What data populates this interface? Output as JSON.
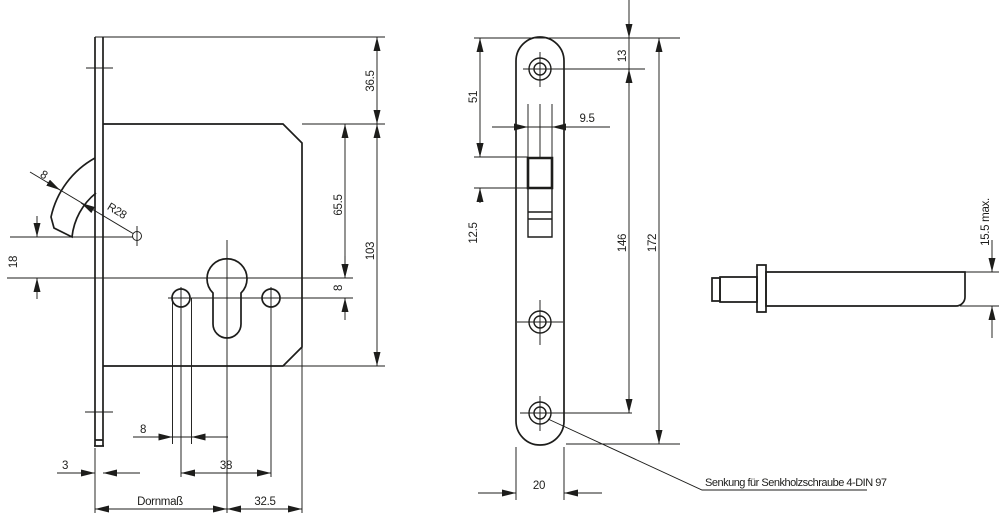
{
  "colors": {
    "line": "#1d1d1b",
    "background": "#ffffff"
  },
  "lock_side_view": {
    "dims": {
      "top_height": "36.5",
      "body_height": "103",
      "cylinder_center": "65.5",
      "hole_offset": "8",
      "hook_pivot_offset": "18",
      "hook_thickness": "8",
      "hook_radius": "R28",
      "hole_diameter": "8",
      "hole_spacing": "38",
      "faceplate_thickness": "3",
      "backset_label": "Dornmaß",
      "edge_distance": "32.5"
    }
  },
  "faceplate_view": {
    "dims": {
      "screw_top_offset": "13",
      "slot_top_offset": "51",
      "slot_width": "9.5",
      "hook_depth": "12.5",
      "screw_spacing": "146",
      "total_length": "172",
      "width": "20"
    }
  },
  "pin_view": {
    "dims": {
      "max_diameter": "15.5 max."
    }
  },
  "annotation": {
    "screw_note": "Senkung für Senkholzschraube 4-DIN 97"
  }
}
